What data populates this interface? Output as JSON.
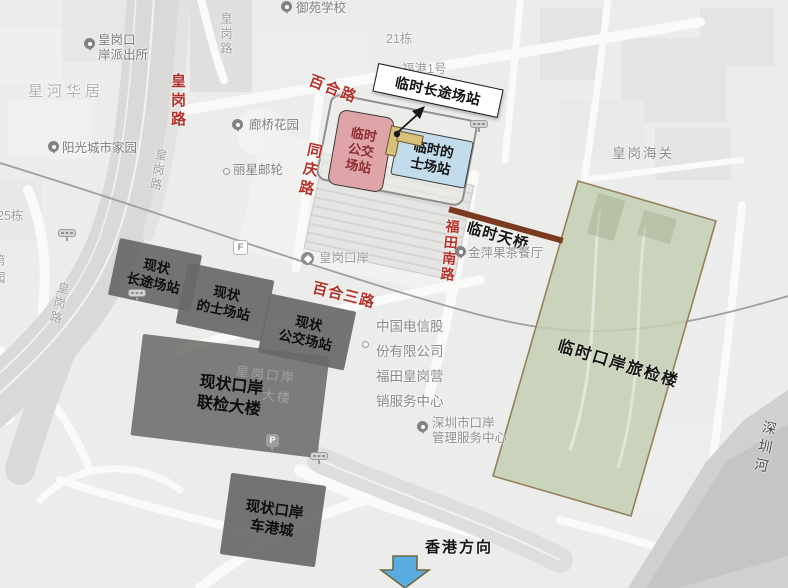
{
  "colors": {
    "map_bg": "#ecedeb",
    "road_label_red": "#b5322c",
    "poi_label_gray": "#7d7d7b",
    "estate_label_gray": "#b2b2b0",
    "temp_bus_box_fill": "#dfa4a8",
    "temp_bus_box_text": "#8c2d33",
    "temp_taxi_box_fill": "#c2dcec",
    "existing_station_box_fill": "#6a6a68",
    "callout_bg": "#ffffff",
    "callout_border": "#1a1a1a",
    "temp_terminal_green_fill": "#cbd3bf",
    "temp_terminal_green_border": "#93815c",
    "temp_bridge_brown": "#7b3a20",
    "hk_arrow_blue": "#58ace1",
    "river_gray": "#d0d0ce"
  },
  "pois": {
    "police_station": {
      "l1": "皇岗口",
      "l2": "岸派出所"
    },
    "xinghe_estate": "星河华居",
    "sunshine_estate": "阳光城市家园",
    "yuyuan_school": "御苑学校",
    "building_21": "21栋",
    "fugang_no1": "福港1号",
    "langqiao_garden": "廊桥花园",
    "lixing_cruise": "丽星邮轮",
    "huanggang_customs": "皇岗海关",
    "building_25": "25栋",
    "edge_char_1": "第",
    "edge_char_2": "园",
    "jinping_restaurant": "金萍果茶餐厅",
    "china_telecom": {
      "l1": "中国电信股",
      "l2": "份有限公司",
      "l3": "福田皇岗营",
      "l4": "销服务中心"
    },
    "metro_station": "皇岗口岸",
    "exit_f": "F",
    "parking_p": "P",
    "ghost_building": {
      "l1": "皇岗口岸",
      "l2": "大楼"
    },
    "port_admin_center": {
      "l1": "深圳市口岸",
      "l2": "管理服务中心"
    },
    "shenzhen_river": "深圳河"
  },
  "roads": {
    "huanggang_rd_red": "皇岗路",
    "huanggang_rd_gray_1": "皇岗路",
    "huanggang_rd_gray_2": "皇岗路",
    "huanggang_rd_gray_3": "皇岗路",
    "baihe_rd": "百合路",
    "tongqing_rd": "同庆路",
    "futian_south_rd": "福田南路",
    "baihe_3rd_rd": "百合三路"
  },
  "stations": {
    "temp_longdistance_callout": "临时长途场站",
    "temp_bus": {
      "l1": "临时",
      "l2": "公交",
      "l3": "场站"
    },
    "temp_taxi": {
      "l1": "临时的",
      "l2": "士场站"
    },
    "existing_longdistance": {
      "l1": "现状",
      "l2": "长途场站"
    },
    "existing_taxi": {
      "l1": "现状",
      "l2": "的士场站"
    },
    "existing_bus": {
      "l1": "现状",
      "l2": "公交场站"
    },
    "existing_joint_inspection": {
      "l1": "现状口岸",
      "l2": "联检大楼"
    },
    "existing_port_plaza": {
      "l1": "现状口岸",
      "l2": "车港城"
    },
    "temp_port_inspection": "临时口岸旅检楼",
    "temp_footbridge": "临时天桥"
  },
  "direction": {
    "hongkong": "香港方向"
  }
}
